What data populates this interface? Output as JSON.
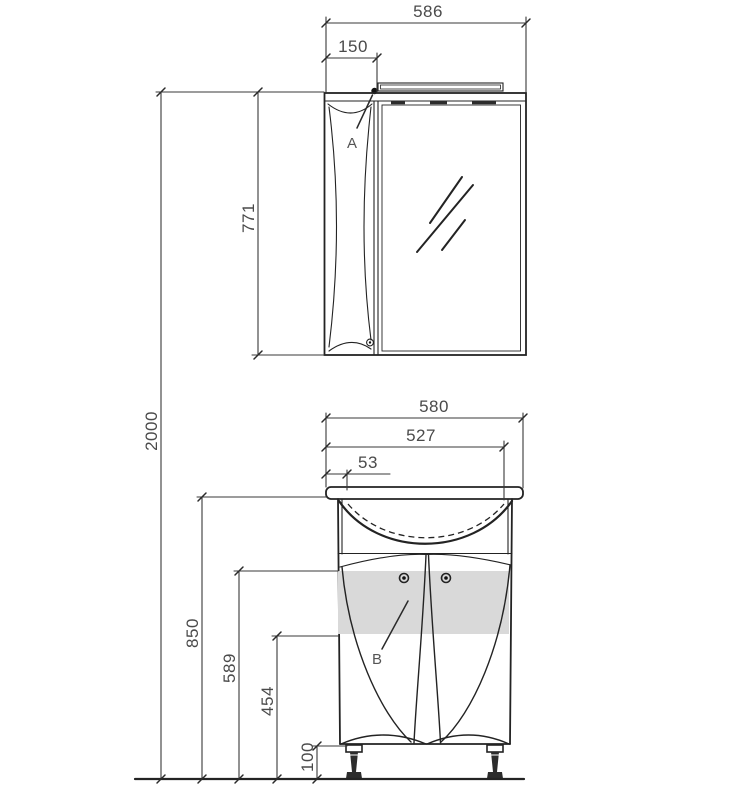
{
  "drawing": {
    "type": "furniture-dimension-diagram",
    "overall": {
      "total_height": "2000"
    },
    "mirror_cabinet": {
      "width": "586",
      "door_width": "150",
      "height": "771",
      "door_label": "A"
    },
    "vanity_unit": {
      "countertop_width": "580",
      "basin_width": "527",
      "left_offset": "53",
      "countertop_height": "850",
      "door_top_height": "589",
      "panel_height": "454",
      "leg_height": "100",
      "door_label": "B"
    },
    "colors": {
      "line": "#232323",
      "dimension_text": "#4a4a4a",
      "highlight_panel": "#d9d9d9",
      "background": "#ffffff"
    }
  }
}
